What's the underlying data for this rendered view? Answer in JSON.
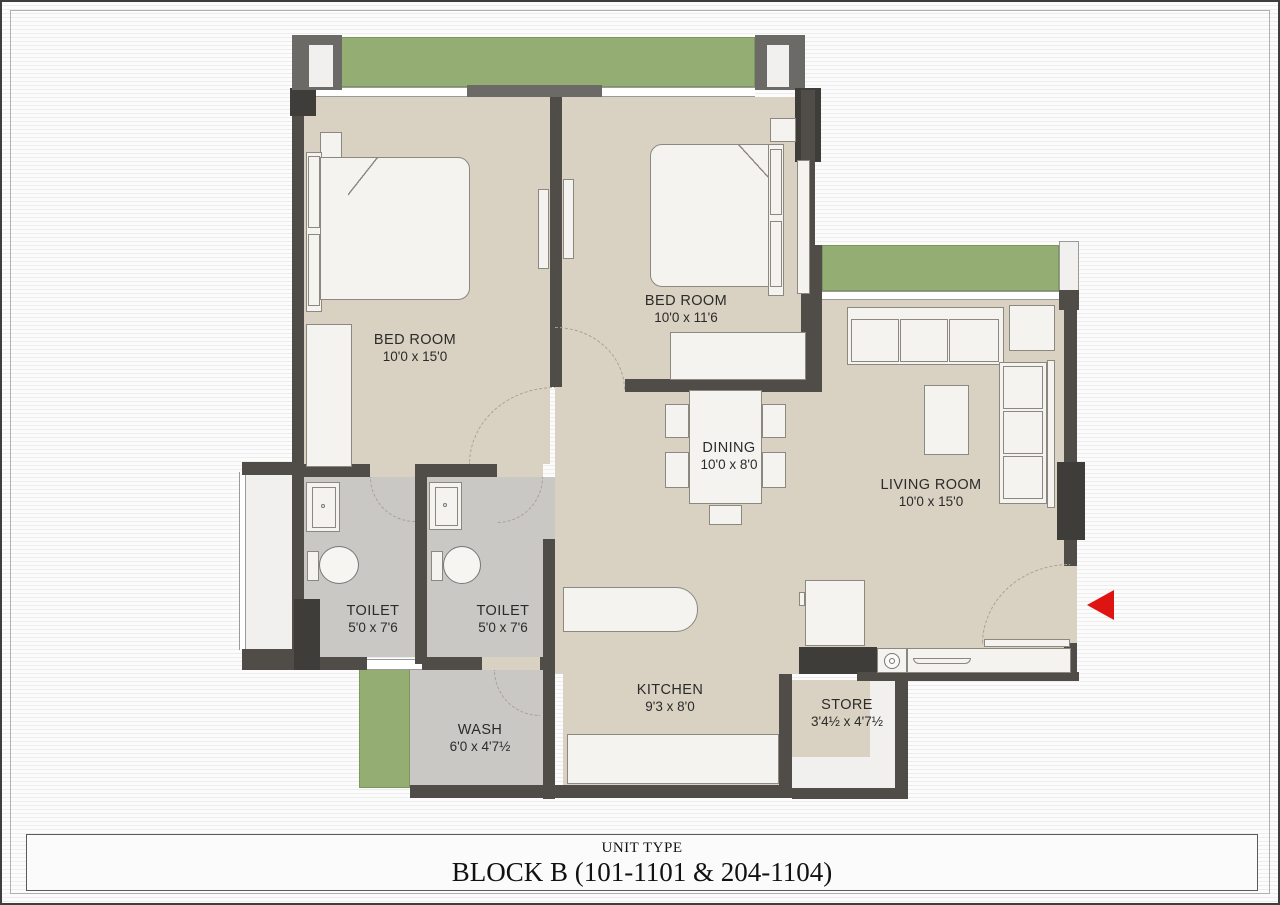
{
  "rooms": {
    "bed1": {
      "name": "BED ROOM",
      "dims": "10'0 x 15'0"
    },
    "bed2": {
      "name": "BED ROOM",
      "dims": "10'0 x 11'6"
    },
    "living": {
      "name": "LIVING ROOM",
      "dims": "10'0 x 15'0"
    },
    "dining": {
      "name": "DINING",
      "dims": "10'0 x 8'0"
    },
    "kitchen": {
      "name": "KITCHEN",
      "dims": "9'3 x 8'0"
    },
    "toilet1": {
      "name": "TOILET",
      "dims": "5'0 x 7'6"
    },
    "toilet2": {
      "name": "TOILET",
      "dims": "5'0 x 7'6"
    },
    "wash": {
      "name": "WASH",
      "dims": "6'0 x 4'7½"
    },
    "store": {
      "name": "STORE",
      "dims": "3'4½ x 4'7½"
    }
  },
  "title_block": {
    "unit_type_label": "UNIT TYPE",
    "block_label": "BLOCK B (101-1101 & 204-1104)"
  },
  "icons": {
    "entrance_arrow": "left-pointing-triangle"
  },
  "colors": {
    "wall": "#504d49",
    "wall2": "#6c6a66",
    "wall3": "#3f3d3a",
    "floor": "#d9d1c1",
    "wet": "#c9c8c5",
    "pale": "#f1f0ee",
    "green": "#94ad72",
    "fur": "#f4f3ef",
    "furb": "#8b8880",
    "arrow": "#de1412",
    "text": "#2b2b2b",
    "arc": "#a8a094"
  }
}
